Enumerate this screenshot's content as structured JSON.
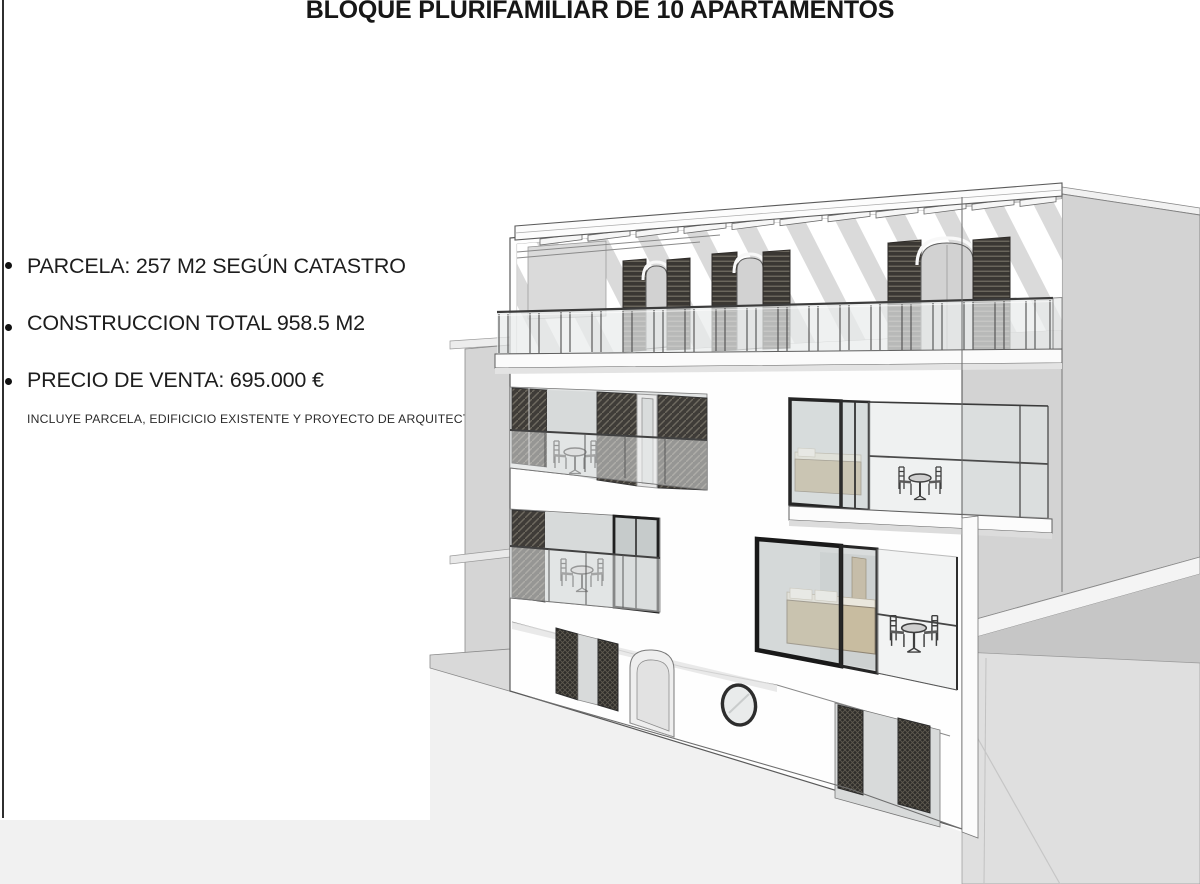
{
  "title": "BLOQUE PLURIFAMILIAR DE 10 APARTAMENTOS",
  "details": {
    "bullets": [
      "PARCELA: 257 M2 SEGÚN CATASTRO",
      "CONSTRUCCION TOTAL 958.5 M2",
      "PRECIO DE VENTA: 695.000 €"
    ],
    "note": "INCLUYE PARCELA, EDIFICICIO EXISTENTE Y PROYECTO DE ARQUITECTURA"
  },
  "illustration": {
    "type": "architectural-3d-render",
    "subject": "apartment-building-street-elevation",
    "colors": {
      "facade": "#fdfdfd",
      "neighbor_wall": "#d3d3d3",
      "street": "#f1f1f1",
      "shutter_dark": "#3a3733",
      "glass": "#e7eaea",
      "bed_tan": "#c8bca0",
      "linework": "#4a4a4a"
    }
  }
}
